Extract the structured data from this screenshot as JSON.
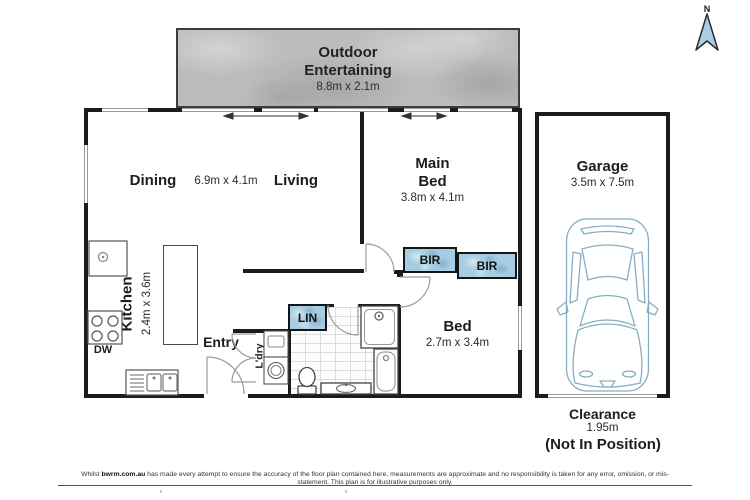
{
  "north": {
    "label": "N"
  },
  "outdoor": {
    "line1": "Outdoor",
    "line2": "Entertaining",
    "dims": "8.8m x 2.1m"
  },
  "living": {
    "dining": "Dining",
    "dims": "6.9m x 4.1m",
    "living": "Living"
  },
  "main_bed": {
    "line1": "Main",
    "line2": "Bed",
    "dims": "3.8m x 4.1m"
  },
  "bed2": {
    "name": "Bed",
    "dims": "2.7m x 3.4m"
  },
  "kitchen": {
    "name": "Kitchen",
    "dims": "2.4m x 3.6m",
    "dishwasher": "DW"
  },
  "entry": {
    "label": "Entry"
  },
  "robes": {
    "bir_main": "BIR",
    "bir_bed2": "BIR",
    "linen": "LIN"
  },
  "laundry": {
    "label": "L'dry"
  },
  "garage": {
    "name": "Garage",
    "dims": "3.5m x 7.5m"
  },
  "clearance": {
    "label": "Clearance",
    "value": "1.95m",
    "note": "(Not In Position)"
  },
  "footer": {
    "prefix": "Whilst ",
    "brand": "bwrm.com.au",
    "text": " has made every attempt to ensure the accuracy of the floor plan contained here, measurements are approximate and no responsibility is taken for any error, omission, or mis-statement. This plan is for illustrative purposes only."
  },
  "colors": {
    "wall": "#1c1c1c",
    "window": "#9a9a9a",
    "robe_fill": "#a6cde2",
    "car_outline": "#85aec3",
    "north_fill": "#a9cfe4",
    "outdoor_base": "#bcbcbc"
  }
}
